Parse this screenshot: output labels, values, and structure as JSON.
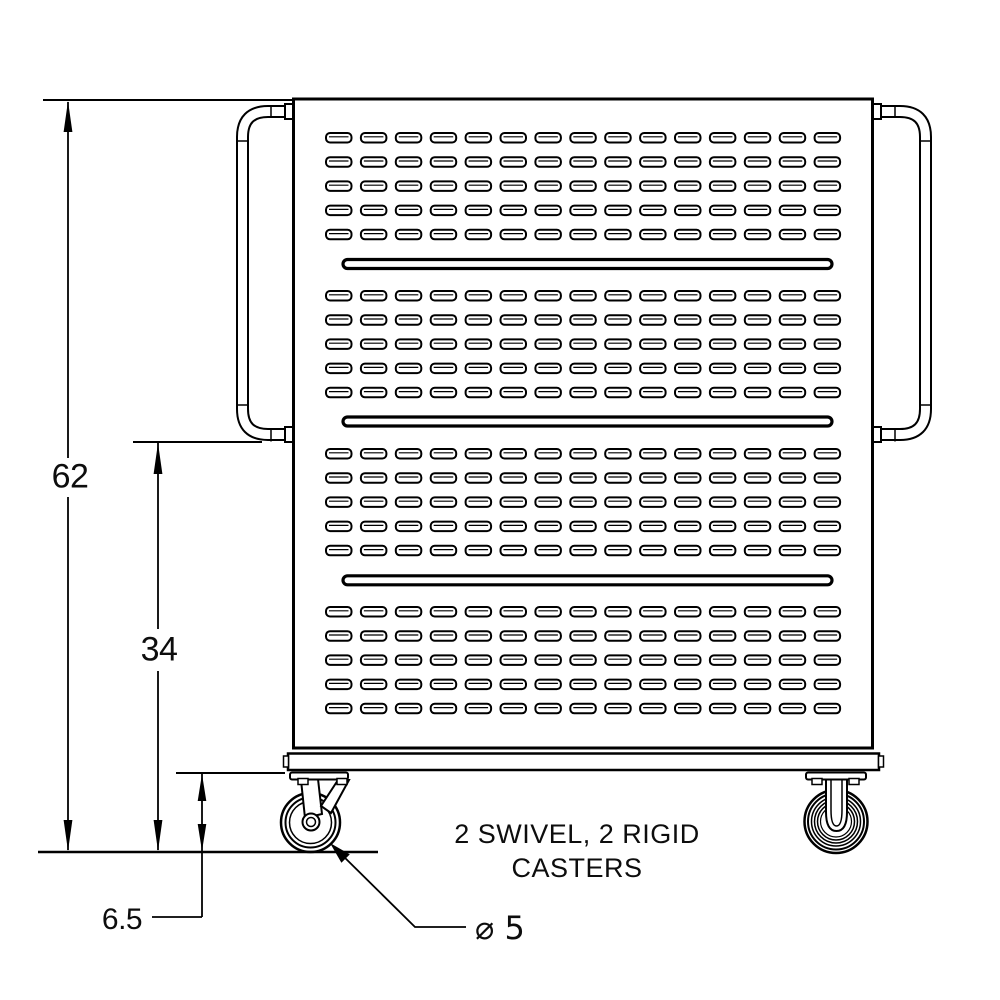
{
  "drawing": {
    "background": "#ffffff",
    "line_color": "#000000",
    "dimensions": {
      "overall_height_label": "62",
      "handle_height_label": "34",
      "caster_height_label": "6.5",
      "caster_diameter_label": "⌀ 5"
    },
    "notes": {
      "casters_line1": "2 SWIVEL, 2 RIGID",
      "casters_line2": "CASTERS"
    },
    "panel": {
      "slot_groups": 4,
      "slot_rows_per_group": 5,
      "slot_columns": 15,
      "long_slot_count": 3
    }
  }
}
